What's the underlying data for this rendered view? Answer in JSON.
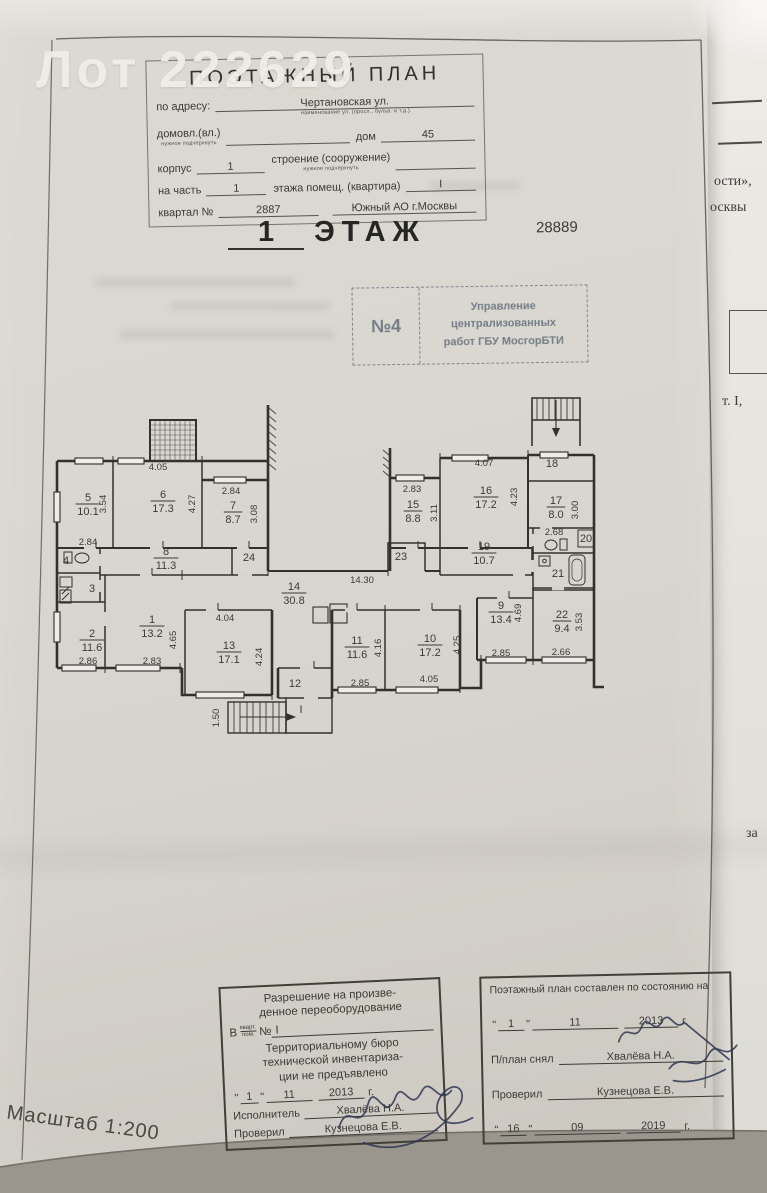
{
  "photo": {
    "watermark": "Лот 222629"
  },
  "doc": {
    "scale": "Масштаб 1:200",
    "sheet_no": "28889",
    "floor_line": {
      "num": "1",
      "word": "ЭТАЖ"
    },
    "header": {
      "title": "ПОЭТАЖНЫЙ ПЛАН",
      "address_label": "по адресу:",
      "address_value": "Чертановская ул.",
      "address_note": "наименование ул. (просп., бульв. и т.д.)",
      "ownership_label": "домовл.(вл.)",
      "ownership_note": "нужное подчеркнуть",
      "house_label": "дом",
      "house_value": "45",
      "korpus_label": "корпус",
      "korpus_value": "1",
      "stroenie_label": "строение (сооружение)",
      "stroenie_note": "нужное подчеркнуть",
      "part_label": "на часть",
      "part_value": "1",
      "floor_part_label": "этажа помещ. (квартира)",
      "floor_part_value": "I",
      "kvartal_label": "квартал №",
      "kvartal_value": "2887",
      "okrug_value": "Южный АО г.Москвы"
    },
    "bti_stamp": {
      "left": "№4",
      "lines": [
        "Управление",
        "централизованных",
        "работ ГБУ МосгорБТИ"
      ]
    },
    "permission_stamp": {
      "line1": "Разрешение на произве-",
      "line2": "денное переоборудование",
      "in_label": "В",
      "kvart": "кварт.",
      "pom": "пом.",
      "num_label": "№",
      "num_value": "I",
      "line3": "Территориальному бюро",
      "line4": "технической инвентариза-",
      "line5": "ции не предъявлено",
      "date": {
        "q": "\"",
        "d": "1",
        "m": "11",
        "y": "2013",
        "g": "г."
      },
      "executor_label": "Исполнитель",
      "executor_value": "Хвалёва Н.А.",
      "checker_label": "Проверил",
      "checker_value": "Кузнецова Е.В."
    },
    "date_stamp": {
      "title": "Поэтажный план составлен по состоянию на",
      "date1": {
        "q": "\"",
        "d": "1",
        "m": "11",
        "y": "2013",
        "g": "г."
      },
      "snapped_label": "П/план снял",
      "snapped_value": "Хвалёва Н.А.",
      "checker_label": "Проверил",
      "checker_value": "Кузнецова Е.В.",
      "date2": {
        "q": "\"",
        "d": "16",
        "m": "09",
        "y": "2019",
        "g": "г."
      }
    },
    "neighbor_fragments": [
      {
        "text": "ости»,",
        "x": 714,
        "y": 174
      },
      {
        "text": "осквы",
        "x": 710,
        "y": 200
      },
      {
        "text": "т.  I,",
        "x": 722,
        "y": 394
      },
      {
        "text": "за",
        "x": 746,
        "y": 826
      }
    ]
  },
  "plan": {
    "rooms": [
      {
        "num": "5",
        "area": "10.1",
        "x": 88,
        "y": 504
      },
      {
        "num": "6",
        "area": "17.3",
        "x": 163,
        "y": 501
      },
      {
        "num": "7",
        "area": "8.7",
        "x": 233,
        "y": 512
      },
      {
        "num": "8",
        "area": "11.3",
        "x": 166,
        "y": 558
      },
      {
        "num": "15",
        "area": "8.8",
        "x": 413,
        "y": 511
      },
      {
        "num": "16",
        "area": "17.2",
        "x": 486,
        "y": 497
      },
      {
        "num": "17",
        "area": "8.0",
        "x": 556,
        "y": 507
      },
      {
        "num": "19",
        "area": "10.7",
        "x": 484,
        "y": 553
      },
      {
        "num": "14",
        "area": "30.8",
        "x": 294,
        "y": 593
      },
      {
        "num": "1",
        "area": "13.2",
        "x": 152,
        "y": 626
      },
      {
        "num": "2",
        "area": "11.6",
        "x": 92,
        "y": 640
      },
      {
        "num": "13",
        "area": "17.1",
        "x": 229,
        "y": 652
      },
      {
        "num": "11",
        "area": "11.6",
        "x": 357,
        "y": 647
      },
      {
        "num": "10",
        "area": "17.2",
        "x": 430,
        "y": 645
      },
      {
        "num": "9",
        "area": "13.4",
        "x": 501,
        "y": 612
      },
      {
        "num": "22",
        "area": "9.4",
        "x": 562,
        "y": 621
      }
    ],
    "marks": [
      {
        "t": "4",
        "x": 66,
        "y": 564
      },
      {
        "t": "3",
        "x": 92,
        "y": 592
      },
      {
        "t": "24",
        "x": 249,
        "y": 561
      },
      {
        "t": "23",
        "x": 401,
        "y": 560
      },
      {
        "t": "18",
        "x": 552,
        "y": 467
      },
      {
        "t": "20",
        "x": 586,
        "y": 542
      },
      {
        "t": "21",
        "x": 558,
        "y": 577
      },
      {
        "t": "12",
        "x": 295,
        "y": 687
      },
      {
        "t": "I",
        "x": 301,
        "y": 713
      }
    ],
    "dims": [
      {
        "t": "4.05",
        "x": 158,
        "y": 470
      },
      {
        "t": "2.84",
        "x": 231,
        "y": 494
      },
      {
        "t": "2.83",
        "x": 412,
        "y": 492
      },
      {
        "t": "4.07",
        "x": 484,
        "y": 466
      },
      {
        "t": "2.84",
        "x": 88,
        "y": 545
      },
      {
        "t": "2.86",
        "x": 88,
        "y": 664
      },
      {
        "t": "2.83",
        "x": 152,
        "y": 664
      },
      {
        "t": "4.04",
        "x": 225,
        "y": 621
      },
      {
        "t": "14.30",
        "x": 362,
        "y": 583
      },
      {
        "t": "2.85",
        "x": 360,
        "y": 686
      },
      {
        "t": "4.05",
        "x": 429,
        "y": 682
      },
      {
        "t": "2.85",
        "x": 501,
        "y": 656
      },
      {
        "t": "2.66",
        "x": 561,
        "y": 655
      },
      {
        "t": "2.68",
        "x": 554,
        "y": 535
      },
      {
        "t": "3.54",
        "x": 106,
        "y": 504,
        "r": -90
      },
      {
        "t": "4.27",
        "x": 195,
        "y": 504,
        "r": -90
      },
      {
        "t": "3.08",
        "x": 257,
        "y": 514,
        "r": -90
      },
      {
        "t": "3.11",
        "x": 437,
        "y": 513,
        "r": -90
      },
      {
        "t": "4.23",
        "x": 517,
        "y": 497,
        "r": -90
      },
      {
        "t": "3.00",
        "x": 578,
        "y": 510,
        "r": -90
      },
      {
        "t": "4.65",
        "x": 176,
        "y": 640,
        "r": -90
      },
      {
        "t": "4.24",
        "x": 262,
        "y": 657,
        "r": -90
      },
      {
        "t": "4.16",
        "x": 381,
        "y": 648,
        "r": -90
      },
      {
        "t": "4.25",
        "x": 460,
        "y": 645,
        "r": -90
      },
      {
        "t": "4.69",
        "x": 521,
        "y": 613,
        "r": -90
      },
      {
        "t": "3.53",
        "x": 582,
        "y": 622,
        "r": -90
      },
      {
        "t": "1.50",
        "x": 219,
        "y": 718,
        "r": -90
      }
    ]
  }
}
